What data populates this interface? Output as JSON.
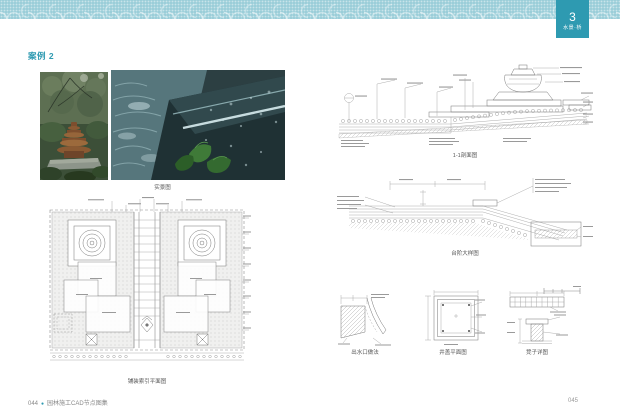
{
  "chapter_tab": {
    "number": "3",
    "label": "水景·桥"
  },
  "left_page": {
    "case_label": "案例 2",
    "photo_caption": "实景图",
    "plan_caption": "铺装索引平面图"
  },
  "right_page": {
    "section_caption": "1-1剖面图",
    "step_detail_caption": "台阶大样图",
    "outlet_detail_caption": "出水口做法",
    "well_plan_caption": "井盖平面图",
    "bench_detail_caption": "凳子详图"
  },
  "footer": {
    "left_page_number": "044",
    "separator": "●",
    "book_title": "园林施工CAD节点图集",
    "right_page_number": "045"
  },
  "colors": {
    "accent": "#2e9ab1",
    "band": "#9bced9"
  }
}
